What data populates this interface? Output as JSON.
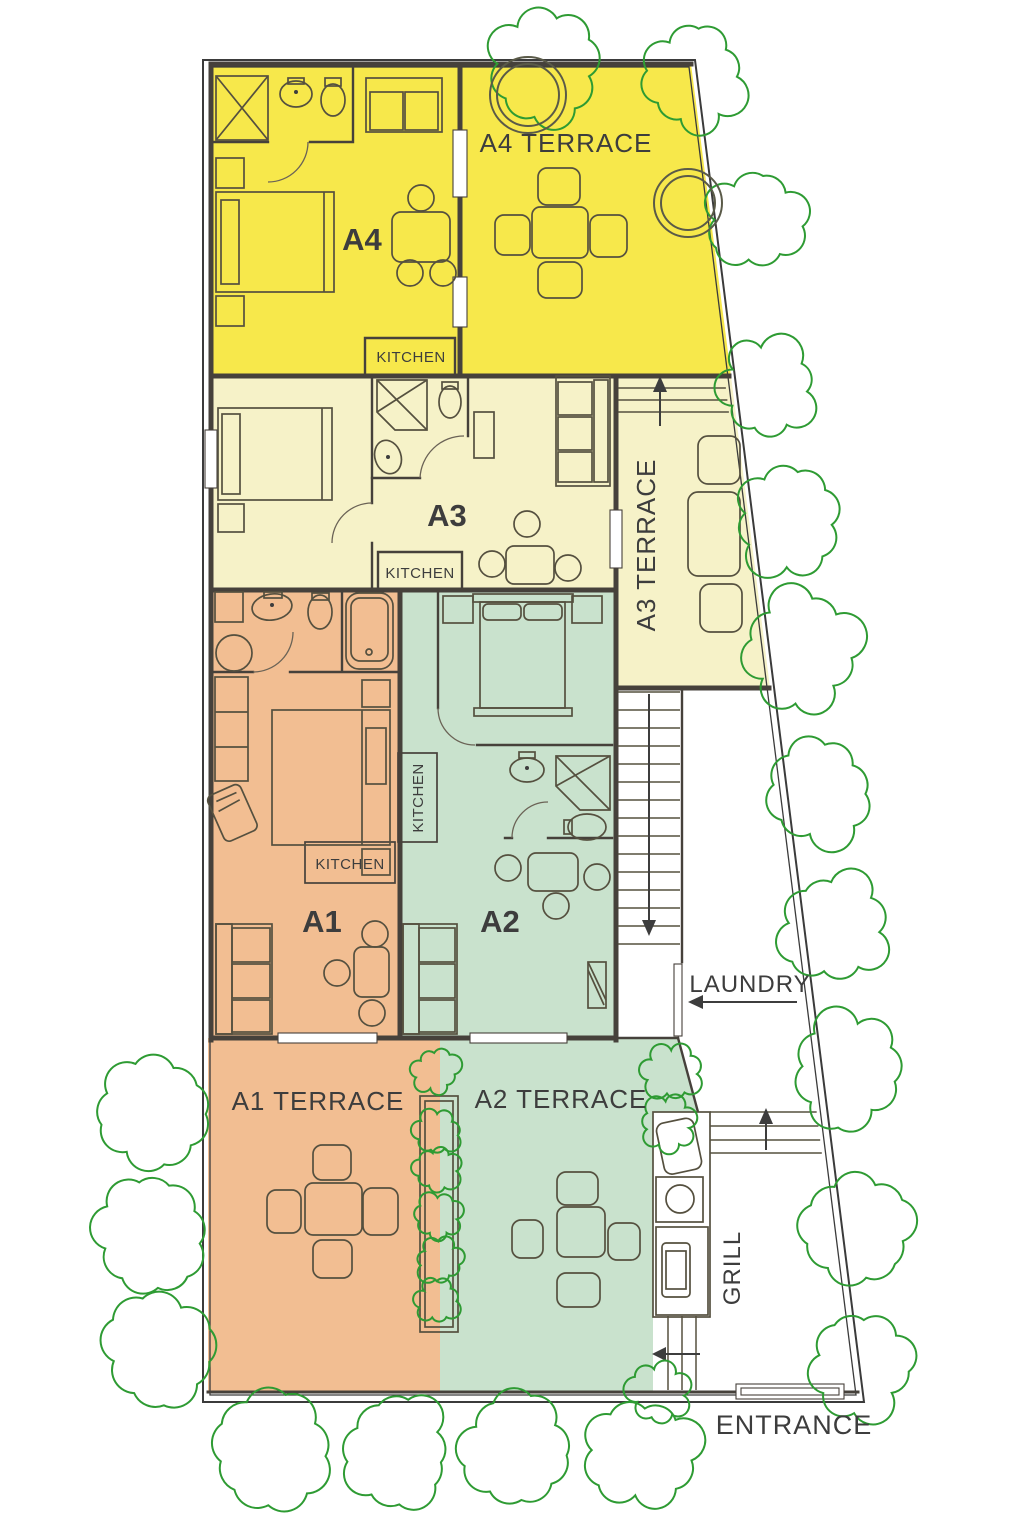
{
  "labels": {
    "a4": "A4",
    "a4_terrace": "A4 TERRACE",
    "kitchen_a4": "KITCHEN",
    "a3": "A3",
    "a3_terrace": "A3 TERRACE",
    "kitchen_a3": "KITCHEN",
    "a1": "A1",
    "kitchen_a1": "KITCHEN",
    "a1_terrace": "A1 TERRACE",
    "a2": "A2",
    "kitchen_a2": "KITCHEN",
    "a2_terrace": "A2 TERRACE",
    "laundry": "LAUNDRY",
    "grill": "GRILL",
    "entrance": "ENTRANCE"
  },
  "colors": {
    "unit_a4": "#f7e84b",
    "unit_a3": "#f6f2c8",
    "unit_a1": "#f2be92",
    "unit_a2": "#c9e2cd",
    "walls": "#46413b",
    "tree_outline": "#2e9b33",
    "text": "#3d3d3d"
  },
  "site": {
    "trees": [
      [
        545,
        66,
        50
      ],
      [
        690,
        76,
        45
      ],
      [
        757,
        220,
        46
      ],
      [
        770,
        388,
        42
      ],
      [
        790,
        520,
        47
      ],
      [
        800,
        650,
        50
      ],
      [
        820,
        792,
        48
      ],
      [
        830,
        928,
        48
      ],
      [
        846,
        1075,
        50
      ],
      [
        858,
        1230,
        52
      ],
      [
        862,
        1362,
        48
      ],
      [
        156,
        1112,
        52
      ],
      [
        154,
        1232,
        52
      ],
      [
        162,
        1352,
        55
      ],
      [
        270,
        1450,
        56
      ],
      [
        397,
        1452,
        52
      ],
      [
        517,
        1450,
        52
      ],
      [
        640,
        1452,
        50
      ],
      [
        672,
        1072,
        24
      ],
      [
        668,
        1124,
        22
      ],
      [
        658,
        1392,
        26
      ]
    ],
    "planter_bushes": [
      [
        436,
        1070,
        20
      ],
      [
        437,
        1133,
        20
      ],
      [
        436,
        1170,
        19
      ],
      [
        438,
        1216,
        20
      ],
      [
        440,
        1261,
        19
      ],
      [
        438,
        1300,
        19
      ]
    ],
    "ring_trees": [
      [
        528,
        95,
        38,
        31
      ],
      [
        688,
        203,
        34,
        27
      ]
    ]
  },
  "stairs": {
    "x1": 618,
    "x2": 680,
    "y_top": 692,
    "y_bottom": 944,
    "treads": 15
  },
  "steps": {
    "terrace_a3": {
      "x1": 618,
      "ys": [
        388,
        400,
        412
      ]
    },
    "court": {
      "x1": 710,
      "ys": [
        1112,
        1126,
        1140,
        1153
      ]
    },
    "grill_bottom": {
      "xs": [
        668,
        682,
        696
      ],
      "y1": 1316,
      "y2": 1390
    }
  }
}
